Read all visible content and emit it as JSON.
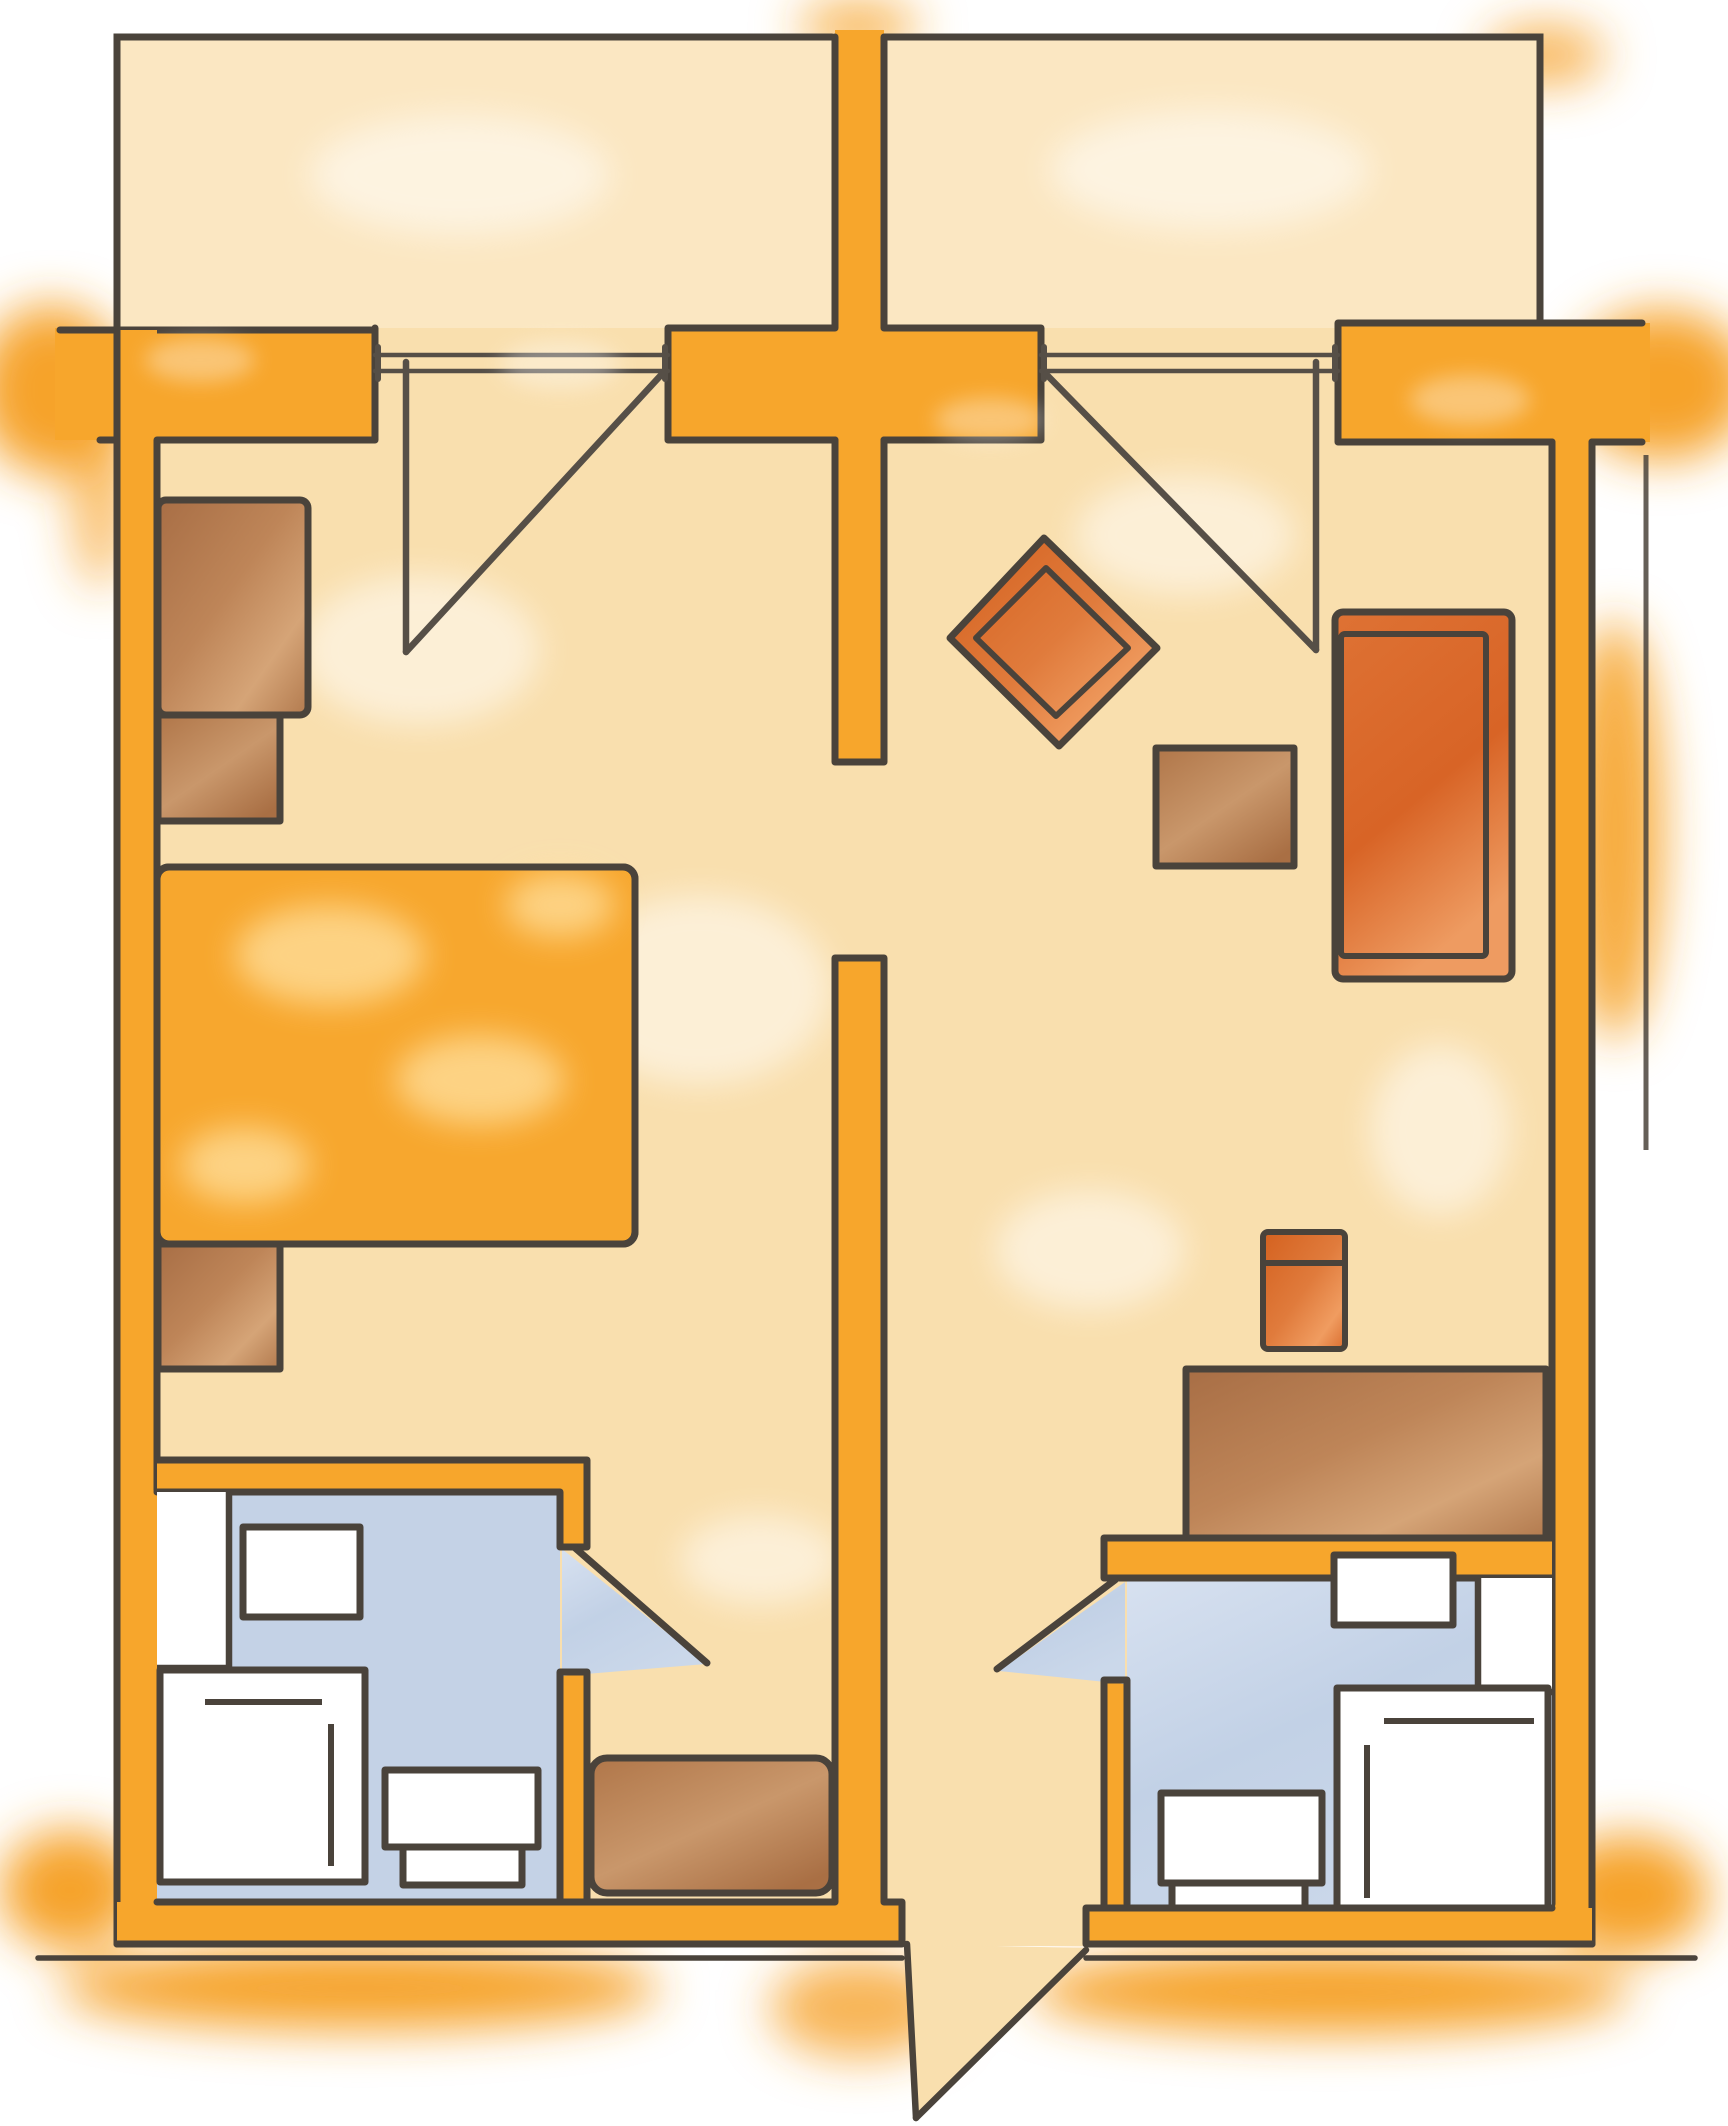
{
  "page": {
    "title": "Hand-drawn floor plan of two mirrored suite rooms",
    "type": "architectural-floor-plan",
    "style": "marker sketch, top-down view",
    "text_labels": []
  },
  "palette": {
    "background": "#FFFFFF",
    "wall_orange": "#F7A62C",
    "glow_orange": "#F6A32A",
    "floor_tan": "#F9DFAE",
    "balcony_tan": "#FBE7C2",
    "outline_dark": "#4A433B",
    "bathroom_floor_blue": "#C4D2E6",
    "bathroom_floor_blue_light": "#E4EBF5",
    "furniture_wood_brown": "#B97F54",
    "furniture_wood_brown_light": "#D8A97C",
    "upholstery_orange_red": "#DB6E35",
    "upholstery_orange_red_light": "#F5A76A",
    "bed_orange": "#F7A72E",
    "fixture_white": "#FFFFFF"
  },
  "areas": {
    "left_balcony": {
      "label": "balcony",
      "features": [
        "railing-walls",
        "sliding-glass-door"
      ]
    },
    "right_balcony": {
      "label": "balcony",
      "features": [
        "railing-walls",
        "sliding-glass-door"
      ]
    },
    "left_room": {
      "label": "bedroom",
      "furniture": [
        "wardrobe",
        "nightstand-upper",
        "double-bed",
        "nightstand-lower",
        "storage-cabinet-in-nook"
      ]
    },
    "right_room": {
      "label": "living room",
      "furniture": [
        "diamond-lounge-chair",
        "coffee-table",
        "sofa",
        "desk-chair",
        "sideboard-desk"
      ]
    },
    "left_bathroom": {
      "label": "bathroom",
      "fixtures": [
        "vanity-counter",
        "washbasin",
        "bathtub",
        "toilet"
      ],
      "door": "swing door opening to entry nook"
    },
    "right_bathroom": {
      "label": "bathroom",
      "fixtures": [
        "vanity-counter",
        "washbasin",
        "bathtub",
        "toilet"
      ],
      "door": "swing door opening to entry hall"
    },
    "entry_hall": {
      "label": "entry hall",
      "features": [
        "entrance-door-swing",
        "connecting-wall-opening"
      ]
    }
  },
  "doors": {
    "balcony_doors": 2,
    "bathroom_doors": 2,
    "entrance_doors": 1,
    "symbol": "leaf line with straight swing chord"
  },
  "counts": {
    "rooms": 2,
    "bathrooms": 2,
    "balconies": 2,
    "beds": 1,
    "sofas": 1
  }
}
